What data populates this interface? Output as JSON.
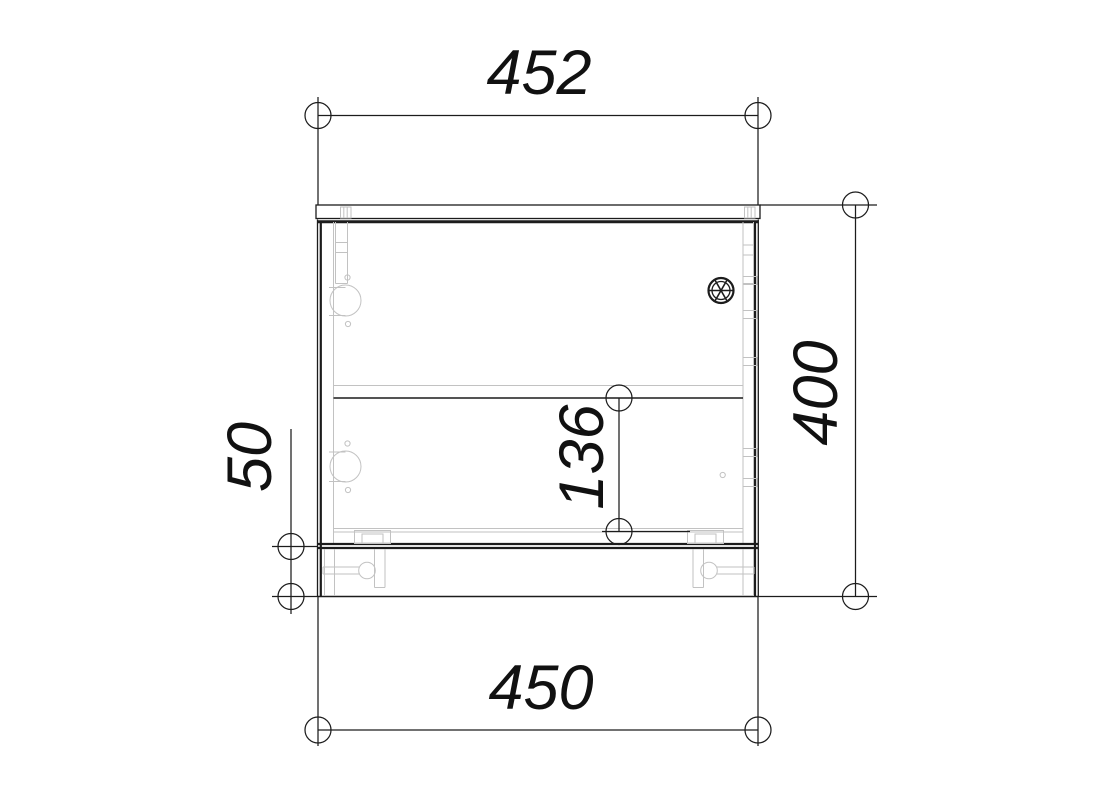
{
  "drawing": {
    "type": "furniture-cabinet-section-technical-drawing",
    "colors": {
      "background": "#ffffff",
      "line_dark": "#1c1c1c",
      "line_light": "#c2c2c2",
      "text": "#111111"
    },
    "dimensions": {
      "top_width": {
        "value": "452"
      },
      "bottom_width": {
        "value": "450"
      },
      "overall_height": {
        "value": "400"
      },
      "shelf_spacing": {
        "value": "136"
      },
      "plinth_height": {
        "value": "50"
      }
    },
    "symbols": {
      "cam_lock": "cam-lock-fitting",
      "hinge_cup": "concealed-hinge-cup",
      "adjustable_leg": "adjustable-leg-foot",
      "shelf_pin": "shelf-pin-hole"
    }
  }
}
